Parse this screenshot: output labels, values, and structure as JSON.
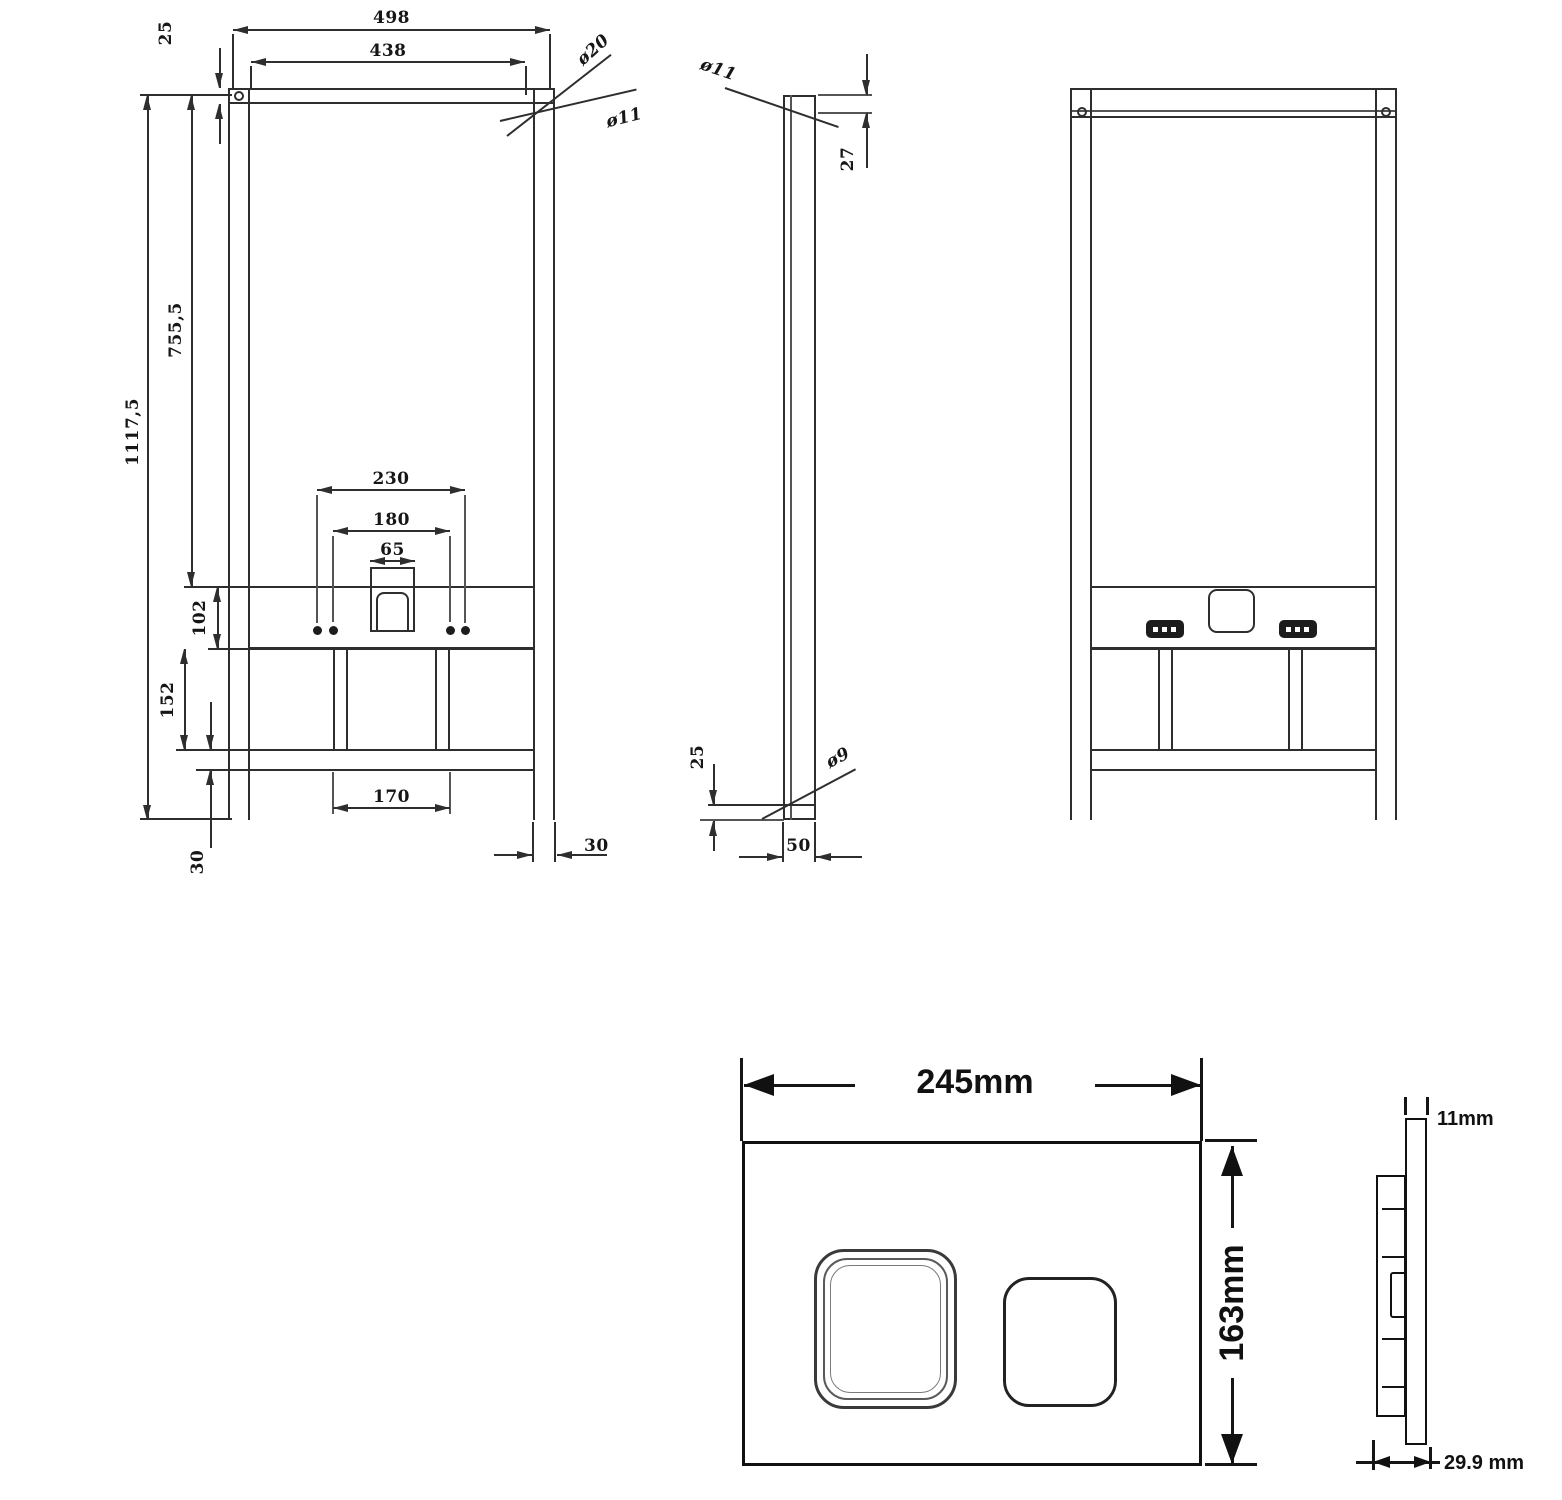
{
  "views": {
    "front": {
      "dim_width_outer": "498",
      "dim_width_inner": "438",
      "dim_top_bar_thickness": "25",
      "dim_hole_top": "ø20",
      "dim_hole_top2": "ø11",
      "dim_total_height": "1117,5",
      "dim_upper_height": "755,5",
      "dim_bracket_band": "102",
      "dim_band_to_rail": "152",
      "dim_rail_thickness": "30",
      "dim_bolt_span_outer": "230",
      "dim_bolt_span_inner": "180",
      "dim_outlet_width": "65",
      "dim_post_span": "170",
      "dim_leg_width": "30"
    },
    "side": {
      "dim_hole_top": "ø11",
      "dim_top_hole_offset": "27",
      "dim_bottom_hole_offset": "25",
      "dim_hole_bottom": "ø9",
      "dim_depth": "50"
    },
    "plate_front": {
      "dim_width": "245mm",
      "dim_height": "163mm"
    },
    "plate_side": {
      "dim_thickness": "11mm",
      "dim_depth": "29.9 mm"
    }
  }
}
